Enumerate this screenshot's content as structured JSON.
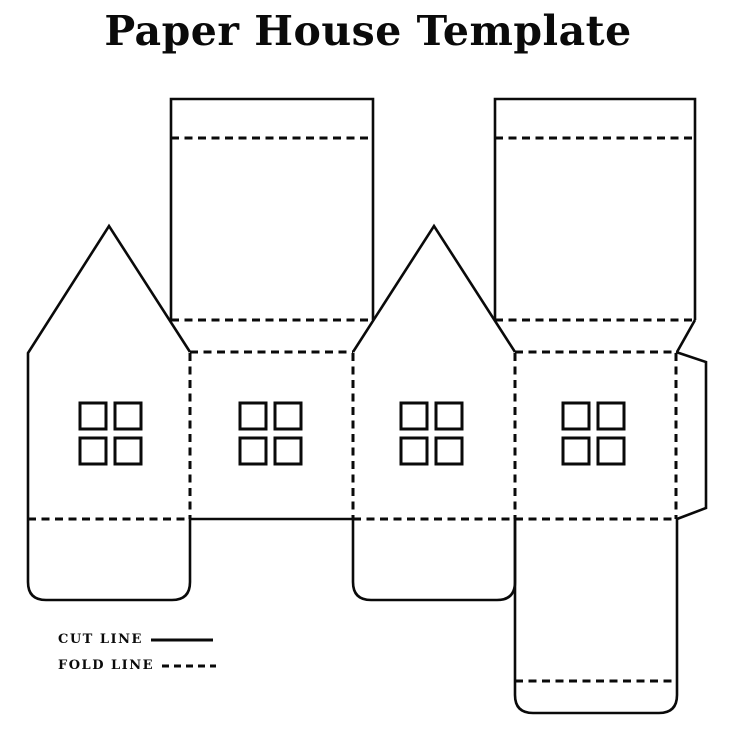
{
  "page": {
    "title": "Paper House Template",
    "background_color": "#ffffff",
    "line_color": "#0a0a0a"
  },
  "legend": {
    "items": [
      {
        "label": "CUT LINE",
        "style": "solid"
      },
      {
        "label": "FOLD LINE",
        "style": "dashed"
      }
    ]
  },
  "template": {
    "parts": {
      "gable_walls": 2,
      "side_walls": 2,
      "roof_panels": 2,
      "window_sets": 4,
      "panes_per_window": 4,
      "glue_tab": 1,
      "bottom_flaps": 2,
      "base_panel": 1
    }
  }
}
